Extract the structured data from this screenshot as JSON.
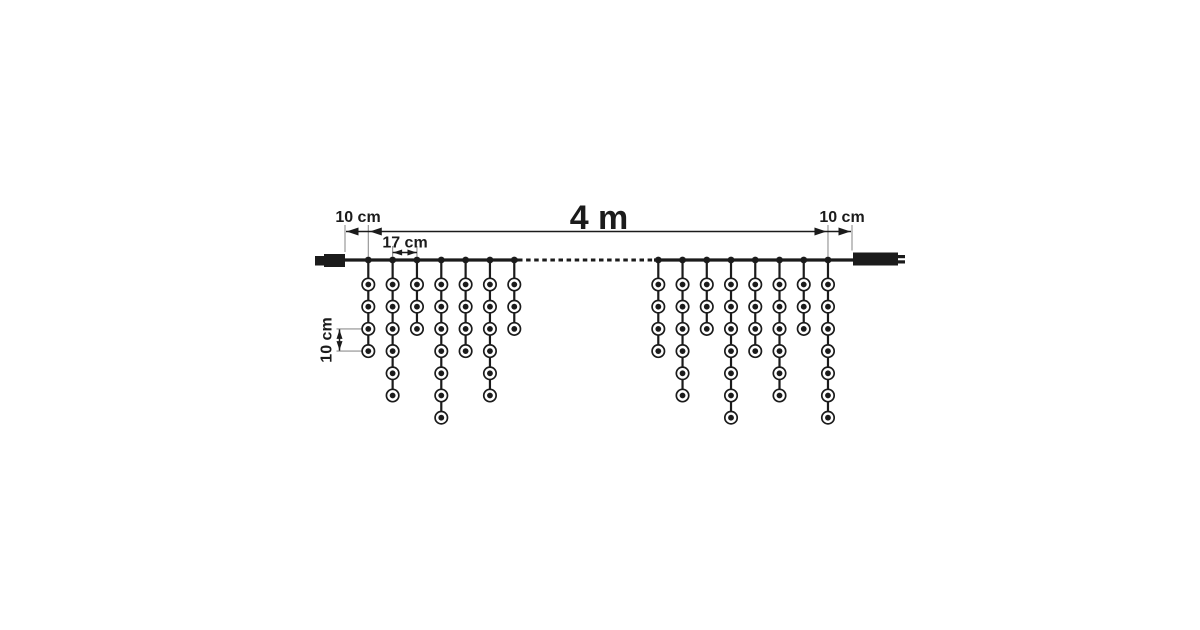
{
  "diagram": {
    "description": "Dimension diagram of a 4 m icicle light curtain with end connectors",
    "background_color": "#ffffff",
    "line_color": "#1b1b1b",
    "extension_line_color": "#8f8f8f",
    "labels": {
      "total_length": "4 m",
      "left_end_offset": "10 cm",
      "right_end_offset": "10 cm",
      "drop_spacing": "17 cm",
      "bulb_spacing": "10 cm"
    },
    "measurements": {
      "total_length_m": 4,
      "end_offset_cm": 10,
      "drop_spacing_cm": 17,
      "bulb_spacing_cm": 10
    },
    "structure": {
      "left_drop_count": 7,
      "right_drop_count": 8,
      "left_group_bulb_counts": [
        4,
        6,
        3,
        7,
        4,
        6,
        3
      ],
      "right_group_bulb_counts": [
        4,
        6,
        3,
        7,
        4,
        6,
        3,
        7
      ]
    },
    "layout": {
      "cable_y": 260,
      "cable_left_x": 345,
      "cable_right_x": 853,
      "dash_start_x": 518,
      "dash_end_x": 654,
      "left_group_start_x": 368.3,
      "left_drop_spacing_px": 24.33,
      "right_group_start_x": 658.3,
      "right_drop_spacing_px": 24.24,
      "first_bulb_y": 284.5,
      "bulb_spacing_y_px": 22.2,
      "dim_line_y": 231.5,
      "drop_dim_y": 252.5,
      "vert_dim_x": 339.5,
      "vert_dim_bulb_from": 3,
      "vert_dim_bulb_to": 4,
      "bulb_outer_r": 6.2,
      "bulb_inner_r": 2.9,
      "node_r": 3.4
    }
  }
}
